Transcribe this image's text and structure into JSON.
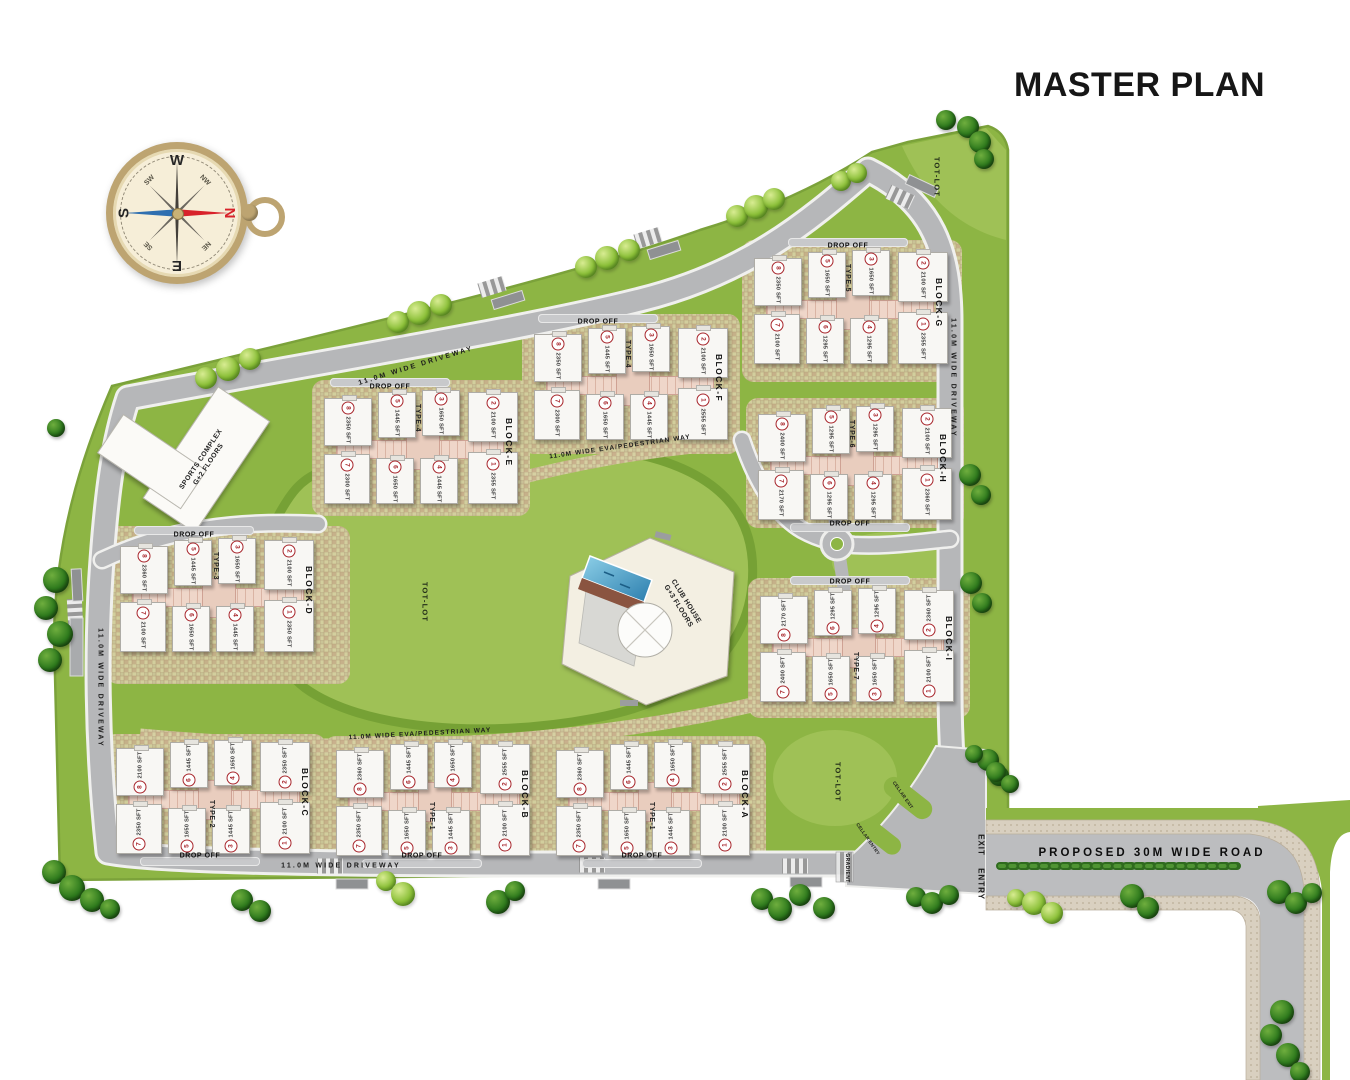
{
  "title": "MASTER PLAN",
  "compass": {
    "w": "W",
    "n": "N",
    "e": "E",
    "s": "S",
    "nw": "NW",
    "ne": "NE",
    "se": "SE",
    "sw": "SW"
  },
  "labels": {
    "driveway": "11.0M WIDE DRIVEWAY",
    "eva": "11.0M WIDE EVA/PEDESTRIAN WAY",
    "tot_lot": "TOT-LOT",
    "drop_off": "DROP OFF",
    "proposed_road": "PROPOSED 30M WIDE ROAD",
    "entry": "ENTRY",
    "exit": "EXIT",
    "gradient": "GRADIENT",
    "cellar_entry": "CELLAR ENTRY",
    "cellar_exit": "CELLAR EXIT"
  },
  "amenities": {
    "sports_complex": {
      "line1": "SPORTS COMPLEX",
      "line2": "G+2 FLOORS"
    },
    "club_house": {
      "line1": "CLUB HOUSE",
      "line2": "G+3 FLOORS"
    }
  },
  "blocks": [
    {
      "name": "BLOCK-G",
      "type": "TYPE-5",
      "units": [
        {
          "no": "1",
          "area": "2355 SFT"
        },
        {
          "no": "2",
          "area": "2100 SFT"
        },
        {
          "no": "3",
          "area": "1650 SFT"
        },
        {
          "no": "4",
          "area": "1295 SFT"
        },
        {
          "no": "5",
          "area": "1650 SFT"
        },
        {
          "no": "6",
          "area": "1295 SFT"
        },
        {
          "no": "7",
          "area": "2100 SFT"
        },
        {
          "no": "8",
          "area": "2350 SFT"
        }
      ]
    },
    {
      "name": "BLOCK-F",
      "type": "TYPE-4",
      "units": [
        {
          "no": "1",
          "area": "2555 SFT"
        },
        {
          "no": "2",
          "area": "2100 SFT"
        },
        {
          "no": "3",
          "area": "1650 SFT"
        },
        {
          "no": "4",
          "area": "1445 SFT"
        },
        {
          "no": "5",
          "area": "1445 SFT"
        },
        {
          "no": "6",
          "area": "1650 SFT"
        },
        {
          "no": "7",
          "area": "2300 SFT"
        },
        {
          "no": "8",
          "area": "2350 SFT"
        }
      ]
    },
    {
      "name": "BLOCK-E",
      "type": "TYPE-4",
      "units": [
        {
          "no": "1",
          "area": "2355 SFT"
        },
        {
          "no": "2",
          "area": "2100 SFT"
        },
        {
          "no": "3",
          "area": "1650 SFT"
        },
        {
          "no": "4",
          "area": "1445 SFT"
        },
        {
          "no": "5",
          "area": "1445 SFT"
        },
        {
          "no": "6",
          "area": "1650 SFT"
        },
        {
          "no": "7",
          "area": "2300 SFT"
        },
        {
          "no": "8",
          "area": "2350 SFT"
        }
      ]
    },
    {
      "name": "BLOCK-H",
      "type": "TYPE-6",
      "units": [
        {
          "no": "1",
          "area": "2360 SFT"
        },
        {
          "no": "2",
          "area": "2100 SFT"
        },
        {
          "no": "3",
          "area": "1295 SFT"
        },
        {
          "no": "4",
          "area": "1295 SFT"
        },
        {
          "no": "5",
          "area": "1295 SFT"
        },
        {
          "no": "6",
          "area": "1295 SFT"
        },
        {
          "no": "7",
          "area": "2170 SFT"
        },
        {
          "no": "8",
          "area": "2400 SFT"
        }
      ]
    },
    {
      "name": "BLOCK-D",
      "type": "TYPE-3",
      "units": [
        {
          "no": "1",
          "area": "2350 SFT"
        },
        {
          "no": "2",
          "area": "2100 SFT"
        },
        {
          "no": "3",
          "area": "1650 SFT"
        },
        {
          "no": "4",
          "area": "1445 SFT"
        },
        {
          "no": "5",
          "area": "1445 SFT"
        },
        {
          "no": "6",
          "area": "1650 SFT"
        },
        {
          "no": "7",
          "area": "2100 SFT"
        },
        {
          "no": "8",
          "area": "2360 SFT"
        }
      ]
    },
    {
      "name": "BLOCK-I",
      "type": "TYPE-7",
      "units": [
        {
          "no": "1",
          "area": "2100 SFT"
        },
        {
          "no": "2",
          "area": "2360 SFT"
        },
        {
          "no": "3",
          "area": "1650 SFT"
        },
        {
          "no": "4",
          "area": "1295 SFT"
        },
        {
          "no": "5",
          "area": "1650 SFT"
        },
        {
          "no": "6",
          "area": "1295 SFT"
        },
        {
          "no": "7",
          "area": "2400 SFT"
        },
        {
          "no": "8",
          "area": "2170 SFT"
        }
      ]
    },
    {
      "name": "BLOCK-C",
      "type": "TYPE-2",
      "units": [
        {
          "no": "1",
          "area": "2100 SFT"
        },
        {
          "no": "2",
          "area": "2350 SFT"
        },
        {
          "no": "3",
          "area": "1445 SFT"
        },
        {
          "no": "4",
          "area": "1650 SFT"
        },
        {
          "no": "5",
          "area": "1650 SFT"
        },
        {
          "no": "6",
          "area": "1445 SFT"
        },
        {
          "no": "7",
          "area": "2350 SFT"
        },
        {
          "no": "8",
          "area": "2100 SFT"
        }
      ]
    },
    {
      "name": "BLOCK-B",
      "type": "TYPE-1",
      "units": [
        {
          "no": "1",
          "area": "2100 SFT"
        },
        {
          "no": "2",
          "area": "2555 SFT"
        },
        {
          "no": "3",
          "area": "1445 SFT"
        },
        {
          "no": "4",
          "area": "1650 SFT"
        },
        {
          "no": "5",
          "area": "1650 SFT"
        },
        {
          "no": "6",
          "area": "1445 SFT"
        },
        {
          "no": "7",
          "area": "2350 SFT"
        },
        {
          "no": "8",
          "area": "2360 SFT"
        }
      ]
    },
    {
      "name": "BLOCK-A",
      "type": "TYPE-1",
      "units": [
        {
          "no": "1",
          "area": "2100 SFT"
        },
        {
          "no": "2",
          "area": "2555 SFT"
        },
        {
          "no": "3",
          "area": "1445 SFT"
        },
        {
          "no": "4",
          "area": "1650 SFT"
        },
        {
          "no": "5",
          "area": "1650 SFT"
        },
        {
          "no": "6",
          "area": "1445 SFT"
        },
        {
          "no": "7",
          "area": "2350 SFT"
        },
        {
          "no": "8",
          "area": "2360 SFT"
        }
      ]
    }
  ],
  "colors": {
    "site_green": "#8db544",
    "lawn_green": "#9fc156",
    "road_gray": "#b6b7b9",
    "hatch_tan": "#d6d0a2",
    "building_white": "#f8f7f4",
    "corridor_pink": "#efd6c9",
    "unit_accent": "#a8262c",
    "hedge_green": "#2f6b1e",
    "sidewalk_tan": "#d9d0c0",
    "compass_gold": "#bda471",
    "title_black": "#161616"
  }
}
